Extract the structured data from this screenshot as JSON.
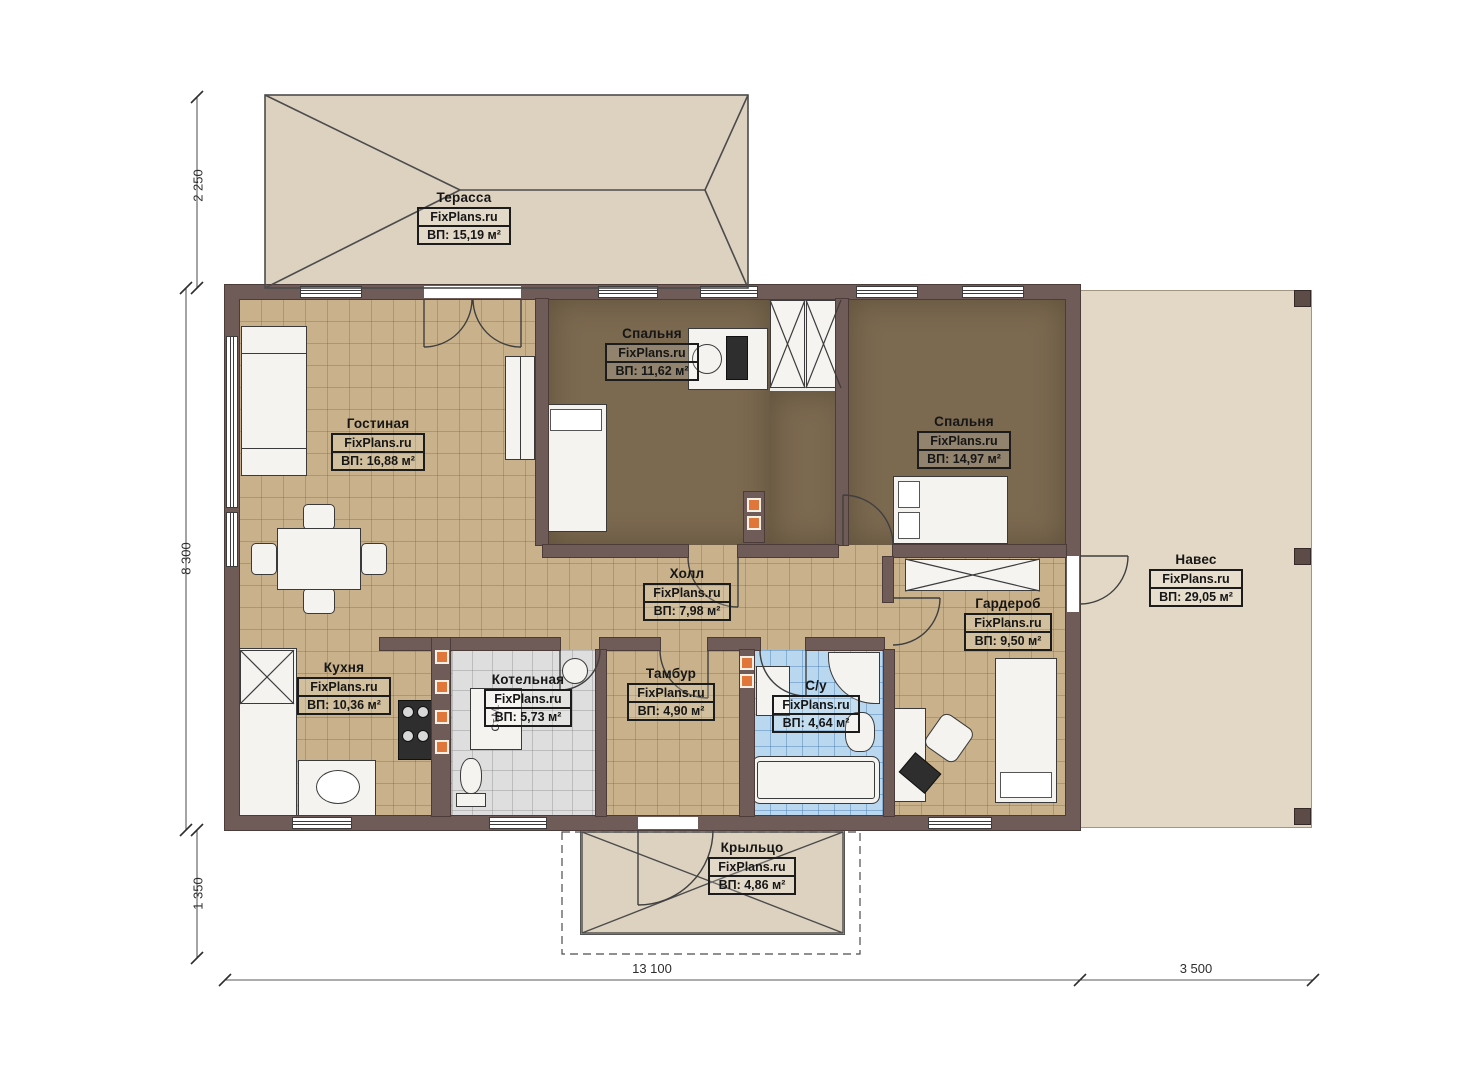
{
  "brand": "FixPlans.ru",
  "rooms": {
    "terrace": {
      "name": "Терасса",
      "area": "ВП: 15,19 м²"
    },
    "living": {
      "name": "Гостиная",
      "area": "ВП: 16,88 м²"
    },
    "bedroom1": {
      "name": "Спальня",
      "area": "ВП: 11,62 м²"
    },
    "bedroom2": {
      "name": "Спальня",
      "area": "ВП: 14,97 м²"
    },
    "hall": {
      "name": "Холл",
      "area": "ВП: 7,98 м²"
    },
    "wardrobe": {
      "name": "Гардероб",
      "area": "ВП: 9,50 м²"
    },
    "canopy": {
      "name": "Навес",
      "area": "ВП: 29,05 м²"
    },
    "kitchen": {
      "name": "Кухня",
      "area": "ВП: 10,36 м²"
    },
    "boiler": {
      "name": "Котельная",
      "area": "ВП: 5,73 м²"
    },
    "vestibule": {
      "name": "Тамбур",
      "area": "ВП: 4,90 м²"
    },
    "bathroom": {
      "name": "С/у",
      "area": "ВП: 4,64 м²"
    },
    "porch": {
      "name": "Крыльцо",
      "area": "ВП: 4,86 м²"
    }
  },
  "dimensions": {
    "left_top": "2 250",
    "left_middle": "8 300",
    "left_bottom": "1 350",
    "bottom_house": "13 100",
    "bottom_canopy": "3 500"
  },
  "annotations": {
    "washing_machine": "Ст.М."
  },
  "colors": {
    "wall": "#6f5b57",
    "floor_wood": "#c9b28b",
    "floor_bedroom": "#7b6950",
    "floor_boiler": "#dedede",
    "floor_bath": "#b9d7ee",
    "outdoor": "#ddd2c0",
    "vent_accent": "#e0763a"
  }
}
